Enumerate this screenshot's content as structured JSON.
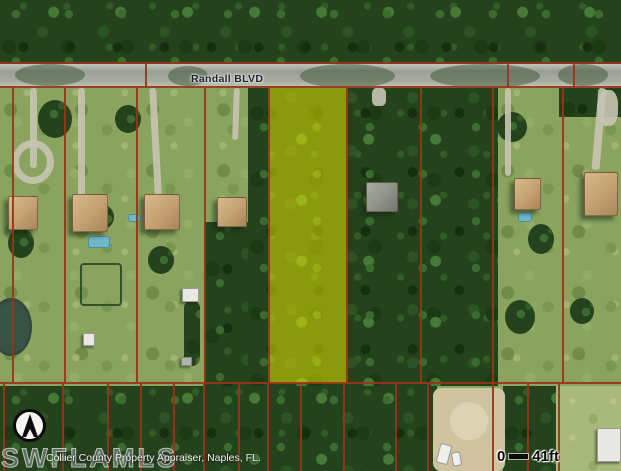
{
  "labels": {
    "road": "Randall BLVD",
    "watermark": "SWFLAMLS",
    "attribution": "Collier County Property Appraiser, Naples, FL."
  },
  "scale": {
    "zero": "0",
    "distance": "41ft"
  },
  "colors": {
    "parcel_line": "#9a3417",
    "highlight_fill": "rgba(233,233,0,0.52)",
    "road": "#9aa096",
    "canopy": "#24431d",
    "grass": "#8aa45f"
  },
  "highlight_parcel": {
    "x": 268,
    "y": 88,
    "w": 79,
    "h": 295
  },
  "map": {
    "shapes": [
      {
        "k": "trees",
        "n": "forest-north",
        "x": 0,
        "y": 0,
        "w": 621,
        "h": 66
      },
      {
        "k": "trees",
        "n": "forest-parcel4",
        "x": 204,
        "y": 222,
        "w": 64,
        "h": 164
      },
      {
        "k": "trees",
        "n": "forest-central",
        "x": 248,
        "y": 66,
        "w": 250,
        "h": 320
      },
      {
        "k": "trees",
        "n": "forest-northeast",
        "x": 559,
        "y": 62,
        "w": 62,
        "h": 55
      },
      {
        "k": "trees",
        "n": "forest-south",
        "x": 0,
        "y": 386,
        "w": 437,
        "h": 85
      },
      {
        "k": "trees",
        "n": "forest-south-2",
        "x": 503,
        "y": 386,
        "w": 57,
        "h": 85
      },
      {
        "k": "clump",
        "n": "tree-clump",
        "x": 38,
        "y": 100,
        "w": 34,
        "h": 38
      },
      {
        "k": "clump",
        "n": "tree-clump",
        "x": 115,
        "y": 105,
        "w": 26,
        "h": 28
      },
      {
        "k": "clump",
        "n": "tree-clump",
        "x": 8,
        "y": 228,
        "w": 26,
        "h": 30
      },
      {
        "k": "clump",
        "n": "tree-clump",
        "x": 92,
        "y": 205,
        "w": 22,
        "h": 24
      },
      {
        "k": "clump",
        "n": "tree-clump",
        "x": 148,
        "y": 246,
        "w": 26,
        "h": 28
      },
      {
        "k": "clump",
        "n": "tree-clump",
        "x": 497,
        "y": 112,
        "w": 30,
        "h": 30
      },
      {
        "k": "clump",
        "n": "tree-clump",
        "x": 528,
        "y": 224,
        "w": 26,
        "h": 30
      },
      {
        "k": "clump",
        "n": "tree-clump",
        "x": 505,
        "y": 300,
        "w": 30,
        "h": 34
      },
      {
        "k": "clump",
        "n": "tree-clump",
        "x": 570,
        "y": 298,
        "w": 24,
        "h": 26
      },
      {
        "k": "clump",
        "n": "hedge-row",
        "x": 184,
        "y": 300,
        "w": 16,
        "h": 66,
        "rad": "8px"
      },
      {
        "k": "grass-light",
        "n": "open-field",
        "x": 556,
        "y": 386,
        "w": 65,
        "h": 85
      },
      {
        "k": "sand",
        "n": "dirt-lot",
        "x": 433,
        "y": 388,
        "w": 72,
        "h": 83,
        "rad": "8px"
      },
      {
        "k": "pond",
        "n": "pond",
        "x": -10,
        "y": 298,
        "w": 42,
        "h": 58
      },
      {
        "k": "fence",
        "n": "fenced-paddock",
        "x": 80,
        "y": 263,
        "w": 42,
        "h": 43
      },
      {
        "k": "road",
        "n": "road-surface",
        "x": 0,
        "y": 64,
        "w": 621,
        "h": 24
      },
      {
        "k": "rshadow",
        "n": "tree-shadow",
        "x": 15,
        "y": 64,
        "w": 70,
        "h": 22
      },
      {
        "k": "rshadow",
        "n": "tree-shadow",
        "x": 168,
        "y": 66,
        "w": 40,
        "h": 20
      },
      {
        "k": "rshadow",
        "n": "tree-shadow",
        "x": 300,
        "y": 64,
        "w": 95,
        "h": 24
      },
      {
        "k": "rshadow",
        "n": "tree-shadow",
        "x": 430,
        "y": 64,
        "w": 110,
        "h": 24
      },
      {
        "k": "rshadow",
        "n": "tree-shadow",
        "x": 558,
        "y": 64,
        "w": 50,
        "h": 22
      },
      {
        "k": "drive",
        "n": "driveway",
        "x": 30,
        "y": 88,
        "w": 7,
        "h": 80
      },
      {
        "k": "ring",
        "n": "circular-driveway",
        "x": 12,
        "y": 140,
        "w": 42,
        "h": 44
      },
      {
        "k": "drive",
        "n": "driveway",
        "x": 78,
        "y": 88,
        "w": 7,
        "h": 108
      },
      {
        "k": "drive",
        "n": "driveway",
        "x": 152,
        "y": 88,
        "w": 7,
        "h": 108,
        "rot": -3
      },
      {
        "k": "drive",
        "n": "driveway",
        "x": 233,
        "y": 88,
        "w": 6,
        "h": 52,
        "rot": 2
      },
      {
        "k": "drive",
        "n": "driveway",
        "x": 372,
        "y": 88,
        "w": 14,
        "h": 18,
        "rad": "30%"
      },
      {
        "k": "drive",
        "n": "driveway",
        "x": 505,
        "y": 88,
        "w": 6,
        "h": 88
      },
      {
        "k": "drive",
        "n": "driveway",
        "x": 595,
        "y": 88,
        "w": 8,
        "h": 82,
        "rot": 5
      },
      {
        "k": "drive",
        "n": "driveway-pad",
        "x": 598,
        "y": 90,
        "w": 20,
        "h": 36,
        "rad": "40%"
      },
      {
        "k": "shed",
        "n": "outbuilding",
        "x": 182,
        "y": 288,
        "w": 17,
        "h": 14
      },
      {
        "k": "shed",
        "n": "outbuilding",
        "x": 83,
        "y": 333,
        "w": 12,
        "h": 13
      },
      {
        "k": "bldg",
        "n": "outbuilding",
        "x": 181,
        "y": 357,
        "w": 11,
        "h": 9
      },
      {
        "k": "shed",
        "n": "outbuilding",
        "x": 597,
        "y": 428,
        "w": 24,
        "h": 34
      },
      {
        "k": "pool",
        "n": "pool",
        "x": 128,
        "y": 214,
        "w": 13,
        "h": 8
      },
      {
        "k": "pool",
        "n": "pool",
        "x": 518,
        "y": 212,
        "w": 14,
        "h": 10
      },
      {
        "k": "pool",
        "n": "pool",
        "x": 88,
        "y": 236,
        "w": 22,
        "h": 12
      },
      {
        "k": "vehicle",
        "n": "vehicle",
        "x": 438,
        "y": 444,
        "w": 12,
        "h": 20,
        "rot": 15
      },
      {
        "k": "vehicle",
        "n": "vehicle",
        "x": 452,
        "y": 452,
        "w": 9,
        "h": 14,
        "rot": -10
      },
      {
        "k": "house",
        "n": "house",
        "x": 8,
        "y": 196,
        "w": 30,
        "h": 34
      },
      {
        "k": "house",
        "n": "house",
        "x": 72,
        "y": 194,
        "w": 36,
        "h": 38
      },
      {
        "k": "house",
        "n": "house",
        "x": 144,
        "y": 194,
        "w": 36,
        "h": 36
      },
      {
        "k": "house",
        "n": "house",
        "x": 217,
        "y": 197,
        "w": 30,
        "h": 30
      },
      {
        "k": "house",
        "n": "house",
        "x": 366,
        "y": 182,
        "w": 32,
        "h": 30,
        "bg": "linear-gradient(135deg,#a8aba2,#8e9188 55%,#75786f)"
      },
      {
        "k": "house",
        "n": "house",
        "x": 514,
        "y": 178,
        "w": 27,
        "h": 32
      },
      {
        "k": "house",
        "n": "house",
        "x": 584,
        "y": 172,
        "w": 34,
        "h": 44
      },
      {
        "k": "overlay",
        "n": "highlighted-parcel",
        "x": 268,
        "y": 88,
        "w": 79,
        "h": 295
      }
    ],
    "lines": {
      "horizontal": [
        {
          "x": 0,
          "y": 62,
          "w": 621
        },
        {
          "x": 0,
          "y": 86,
          "w": 621
        },
        {
          "x": 0,
          "y": 382,
          "w": 621
        }
      ],
      "vertical_front_row": {
        "y": 88,
        "h": 295,
        "xs": [
          12,
          64,
          136,
          204,
          268,
          346,
          420,
          492,
          562
        ]
      },
      "vertical_rear_row": {
        "y": 384,
        "h": 87,
        "xs": [
          3,
          62,
          107,
          140,
          173,
          203,
          238,
          267,
          300,
          343,
          395,
          427,
          492,
          527,
          558
        ]
      },
      "road_crossings": {
        "y": 62,
        "h": 26,
        "xs": [
          145,
          507,
          573
        ]
      }
    }
  }
}
